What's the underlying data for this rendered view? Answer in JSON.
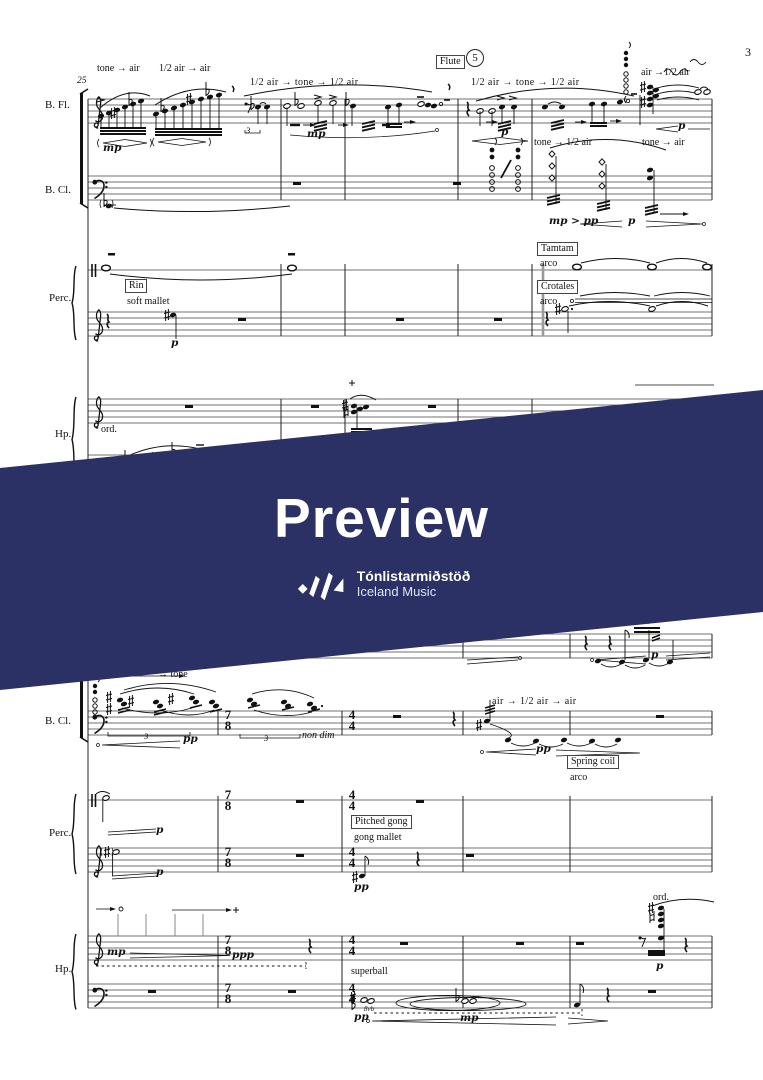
{
  "page": {
    "number": "3",
    "measure_number": "25"
  },
  "rehearsal": {
    "instrument": "Flute",
    "number": "5"
  },
  "banner": {
    "title": "Preview",
    "org": "Tónlistarmiðstöð",
    "org_subtitle": "Iceland Music",
    "background": "#2b3165"
  },
  "instruments": {
    "bass_flute": "B. Fl.",
    "bass_clarinet": "B. Cl.",
    "percussion": "Perc.",
    "harp": "Hp."
  },
  "time_signatures": {
    "seven_eight": {
      "top": "7",
      "bottom": "8"
    },
    "four_four": {
      "top": "4",
      "bottom": "4"
    }
  },
  "tuplet_three": "3",
  "octave_mark": "8vb",
  "labels": {
    "tone_to_air": "tone → air",
    "half_air_to_air": "1/2 air → air",
    "half_air_tone_half_air": "1/2 air → tone → 1/2 air",
    "air_to_half_air": "air →1/2 air",
    "tone_to_half_air": "tone → 1/2 air",
    "to_tone": "→ tone",
    "air_half_air_air": "air → 1/2 air → air",
    "rin": "Rin",
    "soft_mallet": "soft mallet",
    "tamtam": "Tamtam",
    "crotales": "Crotales",
    "arco": "arco",
    "spring_coil": "Spring coil",
    "pitched_gong": "Pitched gong",
    "gong_mallet": "gong mallet",
    "superball": "superball",
    "ord": "ord.",
    "non_dim": "non dim"
  },
  "dynamics": {
    "mp": "mp",
    "p": "p",
    "pp": "pp",
    "ppp": "ppp",
    "mp_dim_pp": "mp > pp"
  }
}
